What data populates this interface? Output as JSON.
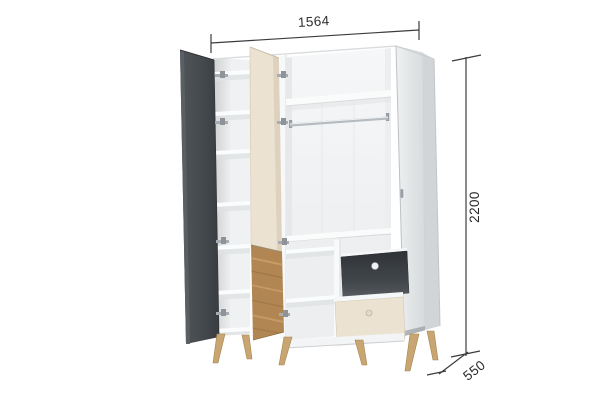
{
  "diagram": {
    "dimensions": {
      "width": {
        "label": "1564"
      },
      "height": {
        "label": "2200"
      },
      "depth": {
        "label": "550"
      }
    },
    "colors": {
      "graphite": "#40454a",
      "cream": "#ebe2d2",
      "oak_wood": "#b28653",
      "leg_wood": "#c9a572",
      "carcass_white": "#ffffff",
      "dimension_line": "#3c3c3c",
      "dimension_text": "#2d2d2d"
    }
  }
}
